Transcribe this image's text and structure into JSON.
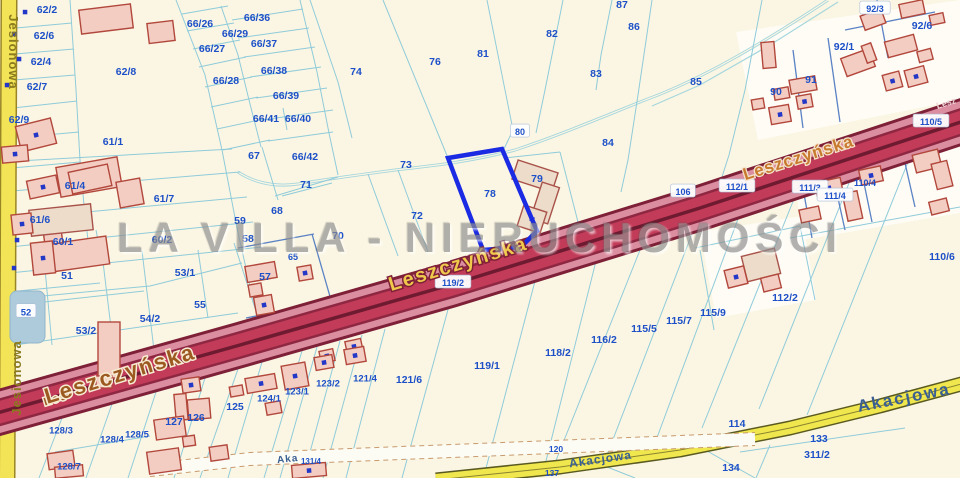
{
  "watermark": {
    "text": "LA VILLA - NIERUCHOMOŚCI"
  },
  "colors": {
    "background": "#FBF6E3",
    "boundary_cyan": "#8FCBDA",
    "boundary_blue": "#5A82C4",
    "parcel_label": "#1D50C8",
    "highlight_blue": "#1B2BE3",
    "road_leszczynska_core": "#C23B58",
    "road_leszczynska_edge": "#DC8EA1",
    "road_leszczynska_dark": "#7E2038",
    "road_yellow": "#F2E84F",
    "building_fill": "#F3CDC2",
    "building_stroke": "#B2473C",
    "pond_fill": "#AECBDC",
    "stream": "#A5D6DE",
    "dot_blue": "#2438C8"
  },
  "map": {
    "highlighted_parcel": {
      "number": "78",
      "points": "448,158 502,149 537,231 521,247 483,250"
    },
    "pond": {
      "x": 10,
      "y": 291,
      "w": 35,
      "h": 52,
      "rx": 7
    },
    "stream_d": "M828,0 C760,45 700,80 645,100 C600,118 560,135 515,150 C470,162 430,166 395,170 C350,176 320,180 298,184 C270,188 250,180 238,172",
    "stream_branch_d": "M838,2 L770,45 L700,85 L652,106",
    "white_areas": [
      "736,32 960,0 960,100 758,140",
      "792,152 960,120 960,213 802,240",
      "700,232 802,216 816,300 716,318"
    ],
    "boundaries_cyan": [
      "M70,0 L76,90 L80,160 L84,205 L90,258",
      "M16,28 L72,23",
      "M15,54 L74,49",
      "M14,80 L75,75",
      "M13,108 L77,101",
      "M12,138 L79,132",
      "M12,168 L80,162",
      "M176,0 L205,75 L222,150 L237,228 L252,295 L264,332",
      "M221,6 L238,55 L249,100 L261,147",
      "M300,0 L317,72 L329,133 L338,175",
      "M182,14 L228,6",
      "M187,31 L234,23",
      "M193,49 L240,40",
      "M199,67 L246,57",
      "M205,87 L252,77",
      "M211,107 L258,97",
      "M217,129 L264,119",
      "M223,150 L270,140",
      "M232,20 L303,9",
      "M238,38 L309,28",
      "M244,57 L315,47",
      "M250,77 L321,67",
      "M256,98 L327,88",
      "M262,120 L333,110",
      "M268,141 L333,132",
      "M283,108 L287,130",
      "M262,147 L278,200",
      "M275,196 L338,177",
      "M0,162 L232,149",
      "M0,192 L240,172",
      "M0,220 L247,197",
      "M0,248 L253,222",
      "M0,274 L262,247",
      "M96,230 L101,256",
      "M0,300 L150,286 L242,263",
      "M44,258 L52,345",
      "M102,254 L114,352",
      "M142,251 L154,350",
      "M198,250 L208,318",
      "M8,292 L100,283",
      "M44,302 L144,291",
      "M8,346 L238,313",
      "M234,243 L262,330",
      "M310,0 L338,82 L352,138",
      "M383,0 L448,158",
      "M448,158 L483,249",
      "M487,0 L513,130 L503,151",
      "M503,151 L537,230",
      "M563,0 L545,90 L536,133",
      "M612,0 L601,55 L596,90",
      "M652,0 L638,95 L628,160 L621,192",
      "M762,0 L745,90 L729,155 L721,180",
      "M560,152 L578,222",
      "M504,158 L560,152",
      "M368,174 L398,256",
      "M398,170 L428,252",
      "M282,196 L332,183",
      "M62,418 L39,478",
      "M112,404 L86,478",
      "M156,392 L128,478",
      "M205,378 L174,478",
      "M238,369 L200,478",
      "M262,362 L228,478",
      "M302,351 L264,478",
      "M317,347 L280,478",
      "M340,341 L303,478",
      "M362,335 L323,478",
      "M385,329 L346,478",
      "M455,284 L402,478",
      "M540,262 L485,472",
      "M600,245 L545,465",
      "M648,230 L553,468",
      "M700,213 L607,455",
      "M745,200 L655,443",
      "M800,184 L702,428",
      "M855,168 L759,409",
      "M912,152 L807,415",
      "M55,452 L150,436",
      "M770,445 L756,478",
      "M740,452 L905,428",
      "M790,238 L960,207",
      "M695,248 L800,226",
      "M700,250 L714,330",
      "M800,226 L815,300",
      "M597,463 L635,478",
      "M700,447 L755,478"
    ],
    "boundaries_blue": [
      "M238,248 L314,234",
      "M312,234 L331,300",
      "M246,318 L320,303",
      "M800,172 L812,238",
      "M830,162 L845,230",
      "M858,154 L872,222",
      "M900,141 L915,207",
      "M793,50 L803,128",
      "M828,38 L840,122",
      "M877,0 L888,58",
      "M845,30 L935,12"
    ],
    "roads": {
      "jesionowa": {
        "d": "M9,0 L7,478",
        "layers": [
          {
            "w": 17,
            "c": "#9A8526"
          },
          {
            "w": 14,
            "c": "#F2E357"
          }
        ]
      },
      "leszczynska": {
        "d": "M-10,415 L240,345 L450,285 L700,208 L970,119",
        "layers": [
          {
            "w": 46,
            "c": "#7E2038"
          },
          {
            "w": 40,
            "c": "#DC8EA1"
          },
          {
            "w": 27,
            "c": "#8E2742"
          },
          {
            "w": 22,
            "c": "#C23B58"
          },
          {
            "w": 3.5,
            "c": "#6E1A30"
          }
        ]
      },
      "akacjowa": {
        "d": "M436,480 L560,467 L680,450 L790,428 L880,406 L965,383",
        "layers": [
          {
            "w": 15,
            "c": "#5A5A20"
          },
          {
            "w": 12,
            "c": "#F0E64E"
          },
          {
            "w": 1,
            "c": "#8A8430"
          }
        ]
      },
      "track_band": {
        "fill_d": "M150,470 L250,459 L755,439",
        "fill_w": 13,
        "fill_c": "#FCFCF4",
        "edges": [
          "M150,463.5 L250,452.5 L755,432.5",
          "M150,476.5 L250,465.5 L755,445.5"
        ],
        "edge_c": "#C89A6E"
      }
    },
    "buildings": [
      [
        80,
        7,
        52,
        24,
        -7,
        0,
        0
      ],
      [
        148,
        22,
        26,
        20,
        -7,
        0,
        0
      ],
      [
        18,
        122,
        36,
        26,
        -14,
        1,
        0
      ],
      [
        58,
        162,
        62,
        30,
        -10,
        0,
        0
      ],
      [
        118,
        180,
        24,
        26,
        -10,
        0,
        0
      ],
      [
        50,
        240,
        58,
        28,
        -8,
        0,
        0
      ],
      [
        44,
        230,
        18,
        14,
        -8,
        0,
        0
      ],
      [
        98,
        322,
        22,
        56,
        0,
        0,
        0
      ],
      [
        96,
        376,
        16,
        12,
        0,
        0,
        0
      ],
      [
        2,
        146,
        26,
        16,
        -5,
        1,
        0
      ],
      [
        70,
        168,
        40,
        22,
        -12,
        0,
        0
      ],
      [
        28,
        178,
        30,
        18,
        -12,
        1,
        0
      ],
      [
        30,
        207,
        62,
        26,
        -6,
        0,
        1
      ],
      [
        12,
        214,
        20,
        20,
        -6,
        1,
        0
      ],
      [
        32,
        242,
        22,
        32,
        -6,
        1,
        0
      ],
      [
        246,
        264,
        30,
        16,
        -10,
        0,
        0
      ],
      [
        249,
        284,
        13,
        12,
        -10,
        0,
        0
      ],
      [
        255,
        296,
        18,
        18,
        -10,
        1,
        0
      ],
      [
        298,
        266,
        14,
        14,
        -10,
        1,
        0
      ],
      [
        514,
        166,
        42,
        20,
        18,
        0,
        1
      ],
      [
        536,
        184,
        18,
        38,
        18,
        0,
        1
      ],
      [
        520,
        208,
        24,
        22,
        18,
        1,
        1
      ],
      [
        762,
        42,
        13,
        26,
        -5,
        0,
        0
      ],
      [
        790,
        78,
        26,
        14,
        -10,
        0,
        0
      ],
      [
        797,
        95,
        15,
        13,
        -10,
        1,
        0
      ],
      [
        774,
        88,
        15,
        11,
        -10,
        0,
        0
      ],
      [
        770,
        106,
        20,
        17,
        -10,
        1,
        0
      ],
      [
        752,
        99,
        12,
        10,
        -10,
        0,
        0
      ],
      [
        843,
        53,
        30,
        19,
        -20,
        0,
        0
      ],
      [
        864,
        44,
        10,
        18,
        -20,
        0,
        0
      ],
      [
        884,
        73,
        17,
        16,
        -15,
        1,
        0
      ],
      [
        886,
        38,
        30,
        16,
        -15,
        0,
        0
      ],
      [
        918,
        50,
        14,
        11,
        -15,
        0,
        0
      ],
      [
        906,
        68,
        20,
        17,
        -15,
        1,
        0
      ],
      [
        862,
        12,
        22,
        15,
        -20,
        0,
        0
      ],
      [
        900,
        2,
        24,
        14,
        -12,
        0,
        0
      ],
      [
        930,
        14,
        14,
        10,
        -12,
        0,
        0
      ],
      [
        914,
        152,
        26,
        18,
        -14,
        0,
        0
      ],
      [
        934,
        162,
        16,
        26,
        -14,
        0,
        0
      ],
      [
        816,
        180,
        26,
        16,
        -12,
        1,
        0
      ],
      [
        845,
        192,
        15,
        28,
        -12,
        0,
        0
      ],
      [
        800,
        208,
        20,
        13,
        -12,
        0,
        0
      ],
      [
        860,
        168,
        22,
        15,
        -12,
        1,
        0
      ],
      [
        930,
        200,
        18,
        13,
        -14,
        0,
        0
      ],
      [
        744,
        252,
        34,
        26,
        -14,
        0,
        1
      ],
      [
        726,
        268,
        20,
        18,
        -14,
        1,
        0
      ],
      [
        762,
        276,
        18,
        14,
        -14,
        0,
        0
      ],
      [
        320,
        350,
        14,
        12,
        -12,
        1,
        0
      ],
      [
        346,
        340,
        16,
        13,
        -12,
        1,
        0
      ],
      [
        246,
        376,
        30,
        15,
        -10,
        1,
        0
      ],
      [
        283,
        364,
        24,
        24,
        -10,
        1,
        0
      ],
      [
        315,
        356,
        18,
        13,
        -10,
        1,
        0
      ],
      [
        345,
        348,
        20,
        15,
        -10,
        1,
        0
      ],
      [
        266,
        402,
        15,
        12,
        -10,
        0,
        0
      ],
      [
        230,
        386,
        13,
        10,
        -10,
        0,
        0
      ],
      [
        175,
        394,
        12,
        26,
        -5,
        0,
        0
      ],
      [
        188,
        399,
        22,
        20,
        -5,
        0,
        0
      ],
      [
        155,
        418,
        30,
        20,
        -8,
        0,
        0
      ],
      [
        183,
        436,
        12,
        10,
        -8,
        0,
        0
      ],
      [
        148,
        450,
        32,
        22,
        -8,
        0,
        0
      ],
      [
        210,
        446,
        18,
        14,
        -8,
        0,
        0
      ],
      [
        182,
        378,
        18,
        14,
        -8,
        1,
        0
      ],
      [
        292,
        464,
        34,
        13,
        -5,
        1,
        0
      ],
      [
        48,
        452,
        26,
        16,
        -8,
        0,
        0
      ],
      [
        55,
        466,
        28,
        11,
        -5,
        0,
        0
      ]
    ],
    "dots": [
      [
        25,
        12
      ],
      [
        14,
        34
      ],
      [
        19,
        59
      ],
      [
        7,
        85
      ],
      [
        17,
        240
      ],
      [
        14,
        268
      ]
    ]
  },
  "parcels": [
    {
      "t": "62/2",
      "x": 47,
      "y": 9
    },
    {
      "t": "62/6",
      "x": 44,
      "y": 35
    },
    {
      "t": "62/4",
      "x": 41,
      "y": 61
    },
    {
      "t": "62/7",
      "x": 37,
      "y": 86
    },
    {
      "t": "62/9",
      "x": 19,
      "y": 119
    },
    {
      "t": "62/8",
      "x": 126,
      "y": 71
    },
    {
      "t": "61/1",
      "x": 113,
      "y": 141
    },
    {
      "t": "66/26",
      "x": 200,
      "y": 23
    },
    {
      "t": "66/29",
      "x": 235,
      "y": 33
    },
    {
      "t": "66/27",
      "x": 212,
      "y": 48
    },
    {
      "t": "66/28",
      "x": 226,
      "y": 80
    },
    {
      "t": "66/36",
      "x": 257,
      "y": 17
    },
    {
      "t": "66/37",
      "x": 264,
      "y": 43
    },
    {
      "t": "66/38",
      "x": 274,
      "y": 70
    },
    {
      "t": "66/39",
      "x": 286,
      "y": 95
    },
    {
      "t": "66/41",
      "x": 266,
      "y": 118
    },
    {
      "t": "66/40",
      "x": 298,
      "y": 118
    },
    {
      "t": "66/42",
      "x": 305,
      "y": 156
    },
    {
      "t": "67",
      "x": 254,
      "y": 155
    },
    {
      "t": "61/4",
      "x": 75,
      "y": 185
    },
    {
      "t": "61/7",
      "x": 164,
      "y": 198
    },
    {
      "t": "61/6",
      "x": 40,
      "y": 219
    },
    {
      "t": "60/1",
      "x": 63,
      "y": 241
    },
    {
      "t": "60/2",
      "x": 162,
      "y": 239
    },
    {
      "t": "59",
      "x": 240,
      "y": 220
    },
    {
      "t": "58",
      "x": 248,
      "y": 238
    },
    {
      "t": "68",
      "x": 277,
      "y": 210
    },
    {
      "t": "71",
      "x": 306,
      "y": 184
    },
    {
      "t": "70",
      "x": 338,
      "y": 235
    },
    {
      "t": "65",
      "x": 293,
      "y": 257,
      "s": 9
    },
    {
      "t": "57",
      "x": 265,
      "y": 276
    },
    {
      "t": "51",
      "x": 67,
      "y": 275
    },
    {
      "t": "53/1",
      "x": 185,
      "y": 272
    },
    {
      "t": "52",
      "x": 26,
      "y": 312,
      "s": 9.5,
      "c": 1
    },
    {
      "t": "53/2",
      "x": 86,
      "y": 330
    },
    {
      "t": "54/2",
      "x": 150,
      "y": 318
    },
    {
      "t": "55",
      "x": 200,
      "y": 304
    },
    {
      "t": "72",
      "x": 417,
      "y": 215
    },
    {
      "t": "73",
      "x": 406,
      "y": 164
    },
    {
      "t": "74",
      "x": 356,
      "y": 71
    },
    {
      "t": "76",
      "x": 435,
      "y": 61
    },
    {
      "t": "81",
      "x": 483,
      "y": 53
    },
    {
      "t": "82",
      "x": 552,
      "y": 33
    },
    {
      "t": "87",
      "x": 622,
      "y": 4
    },
    {
      "t": "86",
      "x": 634,
      "y": 26
    },
    {
      "t": "83",
      "x": 596,
      "y": 73
    },
    {
      "t": "80",
      "x": 520,
      "y": 132,
      "s": 9,
      "c": 1
    },
    {
      "t": "84",
      "x": 608,
      "y": 142
    },
    {
      "t": "85",
      "x": 696,
      "y": 81
    },
    {
      "t": "78",
      "x": 490,
      "y": 193
    },
    {
      "t": "79",
      "x": 537,
      "y": 178
    },
    {
      "t": "90",
      "x": 776,
      "y": 91
    },
    {
      "t": "91",
      "x": 811,
      "y": 79
    },
    {
      "t": "92/1",
      "x": 844,
      "y": 46
    },
    {
      "t": "92/3",
      "x": 875,
      "y": 9,
      "s": 9,
      "c": 1
    },
    {
      "t": "92/6",
      "x": 922,
      "y": 25
    },
    {
      "t": "110/5",
      "x": 931,
      "y": 122,
      "s": 9,
      "c": 1
    },
    {
      "t": "106",
      "x": 683,
      "y": 192,
      "s": 9,
      "c": 1
    },
    {
      "t": "112/1",
      "x": 737,
      "y": 187,
      "s": 9,
      "c": 1
    },
    {
      "t": "111/3",
      "x": 810,
      "y": 188,
      "s": 9,
      "c": 1
    },
    {
      "t": "111/4",
      "x": 835,
      "y": 196,
      "s": 9,
      "c": 1
    },
    {
      "t": "110/4",
      "x": 865,
      "y": 183,
      "s": 9
    },
    {
      "t": "110/6",
      "x": 942,
      "y": 256
    },
    {
      "t": "112/2",
      "x": 785,
      "y": 297
    },
    {
      "t": "119/2",
      "x": 453,
      "y": 283,
      "s": 9,
      "c": 1
    },
    {
      "t": "121/6",
      "x": 409,
      "y": 379
    },
    {
      "t": "121/4",
      "x": 365,
      "y": 378,
      "s": 9.5
    },
    {
      "t": "123/2",
      "x": 328,
      "y": 383,
      "s": 9.5
    },
    {
      "t": "123/1",
      "x": 297,
      "y": 391,
      "s": 9.5
    },
    {
      "t": "124/1",
      "x": 269,
      "y": 398,
      "s": 9.5
    },
    {
      "t": "125",
      "x": 235,
      "y": 406
    },
    {
      "t": "126",
      "x": 196,
      "y": 417
    },
    {
      "t": "127",
      "x": 174,
      "y": 421
    },
    {
      "t": "128/3",
      "x": 61,
      "y": 430,
      "s": 9.5
    },
    {
      "t": "128/4",
      "x": 112,
      "y": 439,
      "s": 9.5
    },
    {
      "t": "128/5",
      "x": 137,
      "y": 434,
      "s": 9.5
    },
    {
      "t": "128/7",
      "x": 69,
      "y": 466,
      "s": 9.5
    },
    {
      "t": "119/1",
      "x": 487,
      "y": 365
    },
    {
      "t": "118/2",
      "x": 558,
      "y": 352
    },
    {
      "t": "116/2",
      "x": 604,
      "y": 339
    },
    {
      "t": "115/5",
      "x": 644,
      "y": 328
    },
    {
      "t": "115/7",
      "x": 679,
      "y": 320
    },
    {
      "t": "115/9",
      "x": 713,
      "y": 312
    },
    {
      "t": "114",
      "x": 737,
      "y": 423
    },
    {
      "t": "133",
      "x": 819,
      "y": 438
    },
    {
      "t": "311/2",
      "x": 817,
      "y": 454
    },
    {
      "t": "134",
      "x": 731,
      "y": 467
    },
    {
      "t": "120",
      "x": 556,
      "y": 449,
      "s": 8.5
    },
    {
      "t": "137",
      "x": 552,
      "y": 473,
      "s": 8.5
    },
    {
      "t": "131/4",
      "x": 311,
      "y": 461,
      "s": 8
    }
  ],
  "street_labels": [
    {
      "text": "Jesionowa",
      "x": 9,
      "y": 52,
      "rot": 90,
      "cls": "jesio",
      "size": 13
    },
    {
      "text": "Jesionowa",
      "x": 21,
      "y": 378,
      "rot": -90,
      "cls": "jesio",
      "size": 13
    },
    {
      "text": "Les",
      "x": 57,
      "y": 402,
      "rot": -17,
      "cls": "lesz-brown",
      "size": 11
    },
    {
      "text": "Leszczyńska",
      "x": 122,
      "y": 381,
      "rot": -17,
      "cls": "lesz-brown",
      "size": 22
    },
    {
      "text": "Leszczyńska",
      "x": 460,
      "y": 270,
      "rot": -17,
      "cls": "lesz-gold",
      "size": 20
    },
    {
      "text": "Leszczyńska",
      "x": 800,
      "y": 163,
      "rot": -17.5,
      "cls": "lesz-orange",
      "size": 17
    },
    {
      "text": "Lesz",
      "x": 947,
      "y": 106,
      "rot": -17.5,
      "cls": "lesz-light",
      "size": 9
    },
    {
      "text": "Akacjowa",
      "x": 905,
      "y": 403,
      "rot": -11,
      "cls": "akac-big",
      "size": 17
    },
    {
      "text": "Akacjowa",
      "x": 601,
      "y": 463,
      "rot": -8,
      "cls": "akac",
      "size": 12
    },
    {
      "text": "Aka",
      "x": 288,
      "y": 462,
      "rot": -6,
      "cls": "akac",
      "size": 10
    }
  ]
}
